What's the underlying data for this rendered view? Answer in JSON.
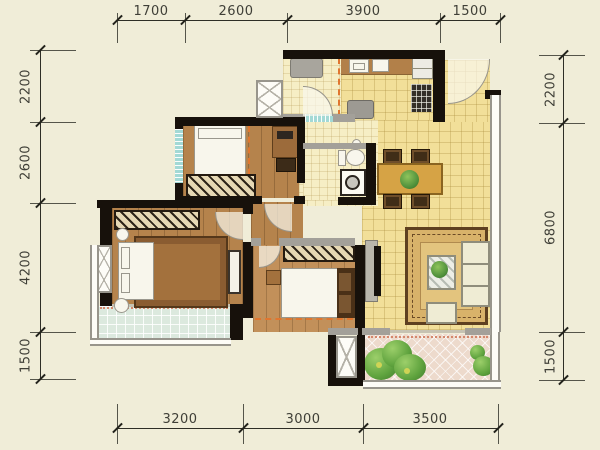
{
  "dimensions": {
    "top": [
      "1700",
      "2600",
      "3900",
      "1500"
    ],
    "left": [
      "2200",
      "2600",
      "4200",
      "1500"
    ],
    "right": [
      "2200",
      "6800",
      "1500"
    ],
    "bottom": [
      "3200",
      "3000",
      "3500"
    ]
  },
  "palette": {
    "background": "#F0EDD8",
    "wall": "#17110B",
    "floor_tile_yellow": "#F2DF99",
    "floor_tile_pale": "#F6EEC5",
    "floor_wood": "#B5834C",
    "balcony_green": "#DCE9DE",
    "balcony_pink": "#EDDACC",
    "window_cyan": "#A3D9D5",
    "rug": "#D8B26A",
    "accent_orange_dash": "#E0762F",
    "accent_salmon_dots": "#D4876C",
    "plant_green": "#4E8F3A",
    "dimension_text": "#3F3F37"
  }
}
